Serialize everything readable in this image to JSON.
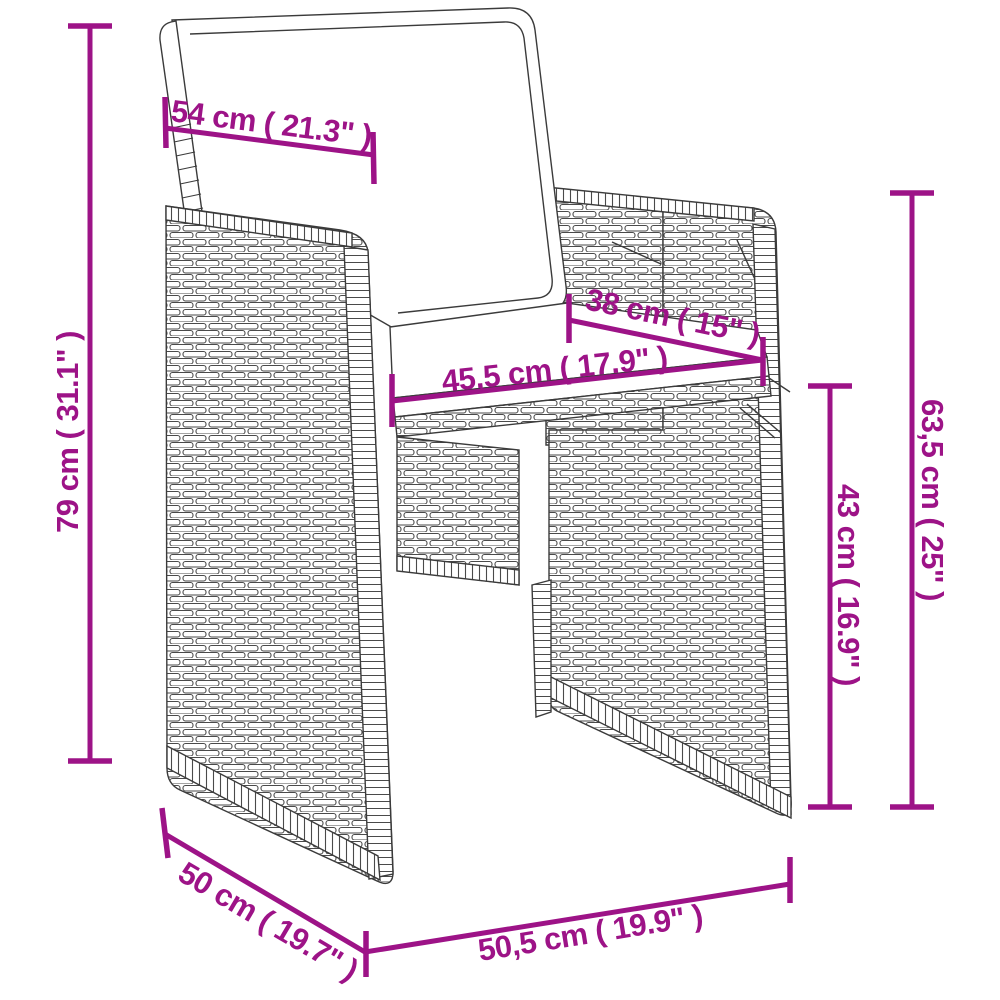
{
  "diagram": {
    "kind": "product-dimension-diagram",
    "product": "poly-rattan garden chair with cushions",
    "accent_color": "#9D1387",
    "line_color": "#3b3b3b",
    "dimensions": {
      "back_width": "54 cm ( 21.3\" )",
      "total_height": "79 cm ( 31.1\" )",
      "seat_depth": "38 cm ( 15\" )",
      "seat_width": "45,5 cm ( 17.9\" )",
      "back_height": "63,5 cm ( 25\" )",
      "seat_height": "43 cm ( 16.9\" )",
      "side_depth": "50 cm ( 19.7\" )",
      "front_width": "50,5 cm ( 19.9\" )"
    }
  }
}
